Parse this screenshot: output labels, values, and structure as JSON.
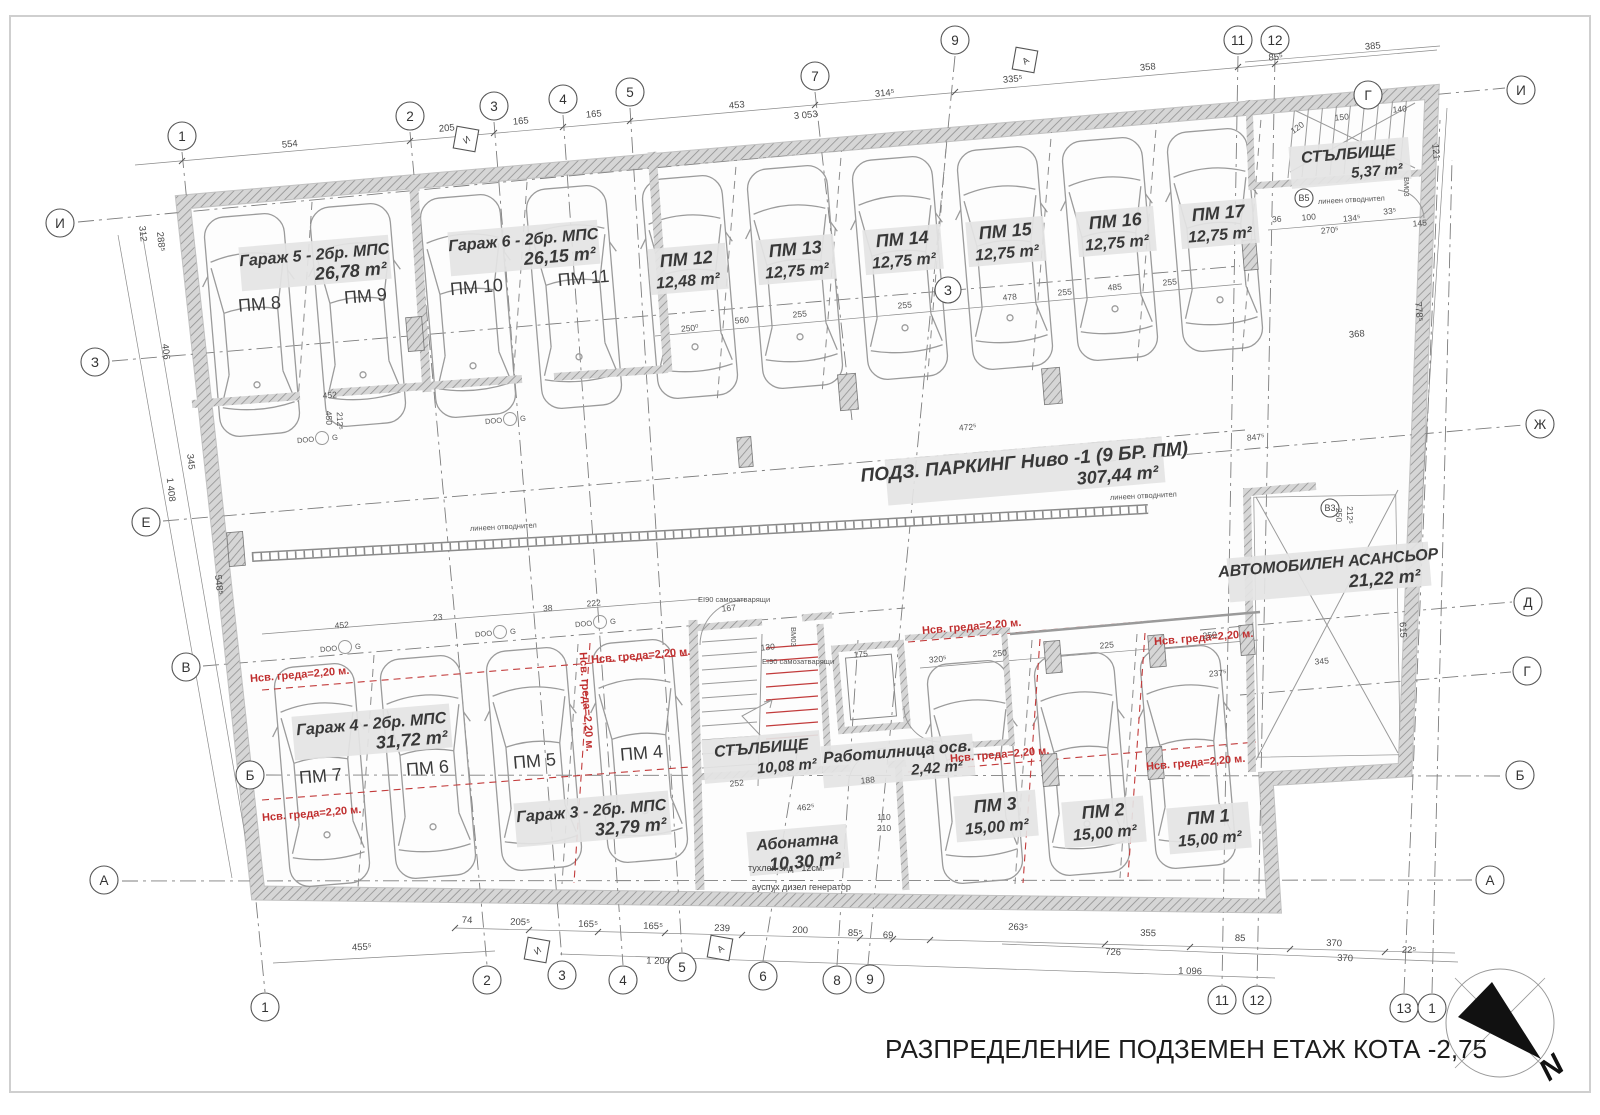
{
  "title": "РАЗПРЕДЕЛЕНИЕ ПОДЗЕМЕН ЕТАЖ КОТА -2,75",
  "north": "N",
  "colors": {
    "red": "#c03030",
    "label_bg": "#e4e4e4",
    "wall_hatch": "#909090"
  },
  "rooms": {
    "garage5": {
      "name": "Гараж 5 - 2бр. МПС",
      "area": "26,78 m²"
    },
    "garage6": {
      "name": "Гараж 6 - 2бр. МПС",
      "area": "26,15 m²"
    },
    "garage4": {
      "name": "Гараж 4 - 2бр. МПС",
      "area": "31,72 m²"
    },
    "garage3": {
      "name": "Гараж 3 - 2бр. МПС",
      "area": "32,79 m²"
    },
    "stairs_top": {
      "name": "СТЪЛБИЩЕ",
      "area": "5,37 m²"
    },
    "stairs_main": {
      "name": "СТЪЛБИЩЕ",
      "area": "10,08 m²"
    },
    "workshop": {
      "name": "Работилница осв.",
      "area": "2,42 m²"
    },
    "abonatna": {
      "name": "Абонатна",
      "area": "10,30 m²"
    },
    "parking": {
      "name": "ПОДЗ. ПАРКИНГ Ниво -1 (9 БР. ПМ)",
      "area": "307,44 m²"
    },
    "car_lift": {
      "name": "АВТОМОБИЛЕН АСАНСЬОР",
      "area": "21,22 m²"
    }
  },
  "spots": {
    "pm1": {
      "label": "ПМ 1",
      "area": "15,00 m²"
    },
    "pm2": {
      "label": "ПМ 2",
      "area": "15,00 m²"
    },
    "pm3": {
      "label": "ПМ 3",
      "area": "15,00 m²"
    },
    "pm4": {
      "label": "ПМ 4"
    },
    "pm5": {
      "label": "ПМ 5"
    },
    "pm6": {
      "label": "ПМ 6"
    },
    "pm7": {
      "label": "ПМ 7"
    },
    "pm8": {
      "label": "ПМ 8"
    },
    "pm9": {
      "label": "ПМ 9"
    },
    "pm10": {
      "label": "ПМ 10"
    },
    "pm11": {
      "label": "ПМ 11"
    },
    "pm12": {
      "label": "ПМ 12",
      "area": "12,48 m²"
    },
    "pm13": {
      "label": "ПМ 13",
      "area": "12,75 m²"
    },
    "pm14": {
      "label": "ПМ 14",
      "area": "12,75 m²"
    },
    "pm15": {
      "label": "ПМ 15",
      "area": "12,75 m²"
    },
    "pm16": {
      "label": "ПМ 16",
      "area": "12,75 m²"
    },
    "pm17": {
      "label": "ПМ 17",
      "area": "12,75 m²"
    }
  },
  "grid": {
    "top": [
      "1",
      "2",
      "3",
      "4",
      "5",
      "7",
      "9",
      "11",
      "12",
      "Г",
      "И"
    ],
    "left": [
      "И",
      "З",
      "Е",
      "В",
      "Б",
      "А"
    ],
    "right": [
      "Ж",
      "Д",
      "Г",
      "Б",
      "А"
    ],
    "bottom": [
      "1",
      "2",
      "3",
      "4",
      "5",
      "6",
      "8",
      "9",
      "11",
      "12",
      "13",
      "1"
    ],
    "mid": [
      "З"
    ],
    "diamonds": [
      "И",
      "А",
      "И",
      "А"
    ],
    "b5": "В5",
    "v3": "В3"
  },
  "notes": {
    "beam": "Нсв. греда=2,20 м.",
    "drain": "линеен отводнител",
    "brick": "тухлен зид - 12см.",
    "exhaust": "ауспух дизел генератор",
    "door": "EI90 самозатварящи",
    "vm03": "ВМ03",
    "doo": "DOO",
    "g": "G"
  },
  "dims": {
    "top": [
      "554",
      "205",
      "165",
      "165",
      "453",
      "3 053",
      "314⁵",
      "335⁵",
      "358",
      "85⁵",
      "385"
    ],
    "bottom": [
      "74",
      "205⁵",
      "165⁵",
      "165⁵",
      "239",
      "200",
      "85⁵",
      "69",
      "263⁵",
      "355",
      "85",
      "370",
      "726",
      "370",
      "1 204⁵",
      "1 096",
      "455⁵",
      "22⁵"
    ],
    "left": [
      "312",
      "288⁵",
      "406",
      "345",
      "1 408",
      "548⁵"
    ],
    "right": [
      "368",
      "778⁵",
      "615",
      "121",
      "250",
      "212⁵"
    ],
    "inner": [
      "250⁰",
      "560",
      "255",
      "255",
      "478",
      "255",
      "485",
      "255",
      "472⁵",
      "847⁵",
      "452",
      "450",
      "212⁵",
      "452",
      "222",
      "38",
      "23",
      "320⁵",
      "250",
      "225",
      "250",
      "237⁵",
      "150",
      "140",
      "120",
      "134⁵",
      "270⁵",
      "100",
      "36",
      "33⁵",
      "145",
      "252",
      "188",
      "462⁵",
      "175",
      "110",
      "210",
      "130",
      "167",
      "345"
    ]
  }
}
